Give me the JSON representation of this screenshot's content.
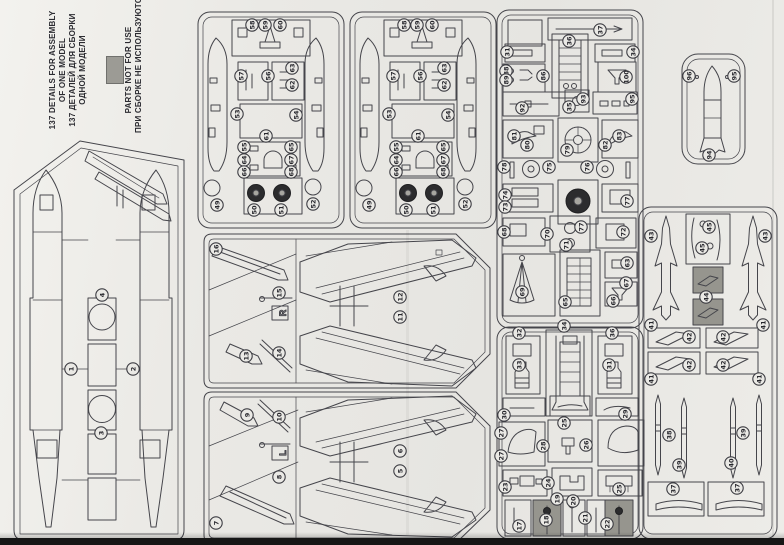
{
  "document": {
    "kind": "model kit sprue parts map (photographed sheet)",
    "header": {
      "count_note_en_1": "137 DETAILS FOR ASSEMBLY",
      "count_note_en_2": "OF ONE MODEL",
      "count_note_ru_1": "137 ДЕТАЛЕЙ ДЛЯ СБОРКИ",
      "count_note_ru_2": "ОДНОЙ МОДЕЛИ",
      "not_for_use_en": "PARTS NOT FOR USE",
      "not_for_use_ru": "ПРИ СБОРКЕ НЕ ИСПОЛЬЗУЮТСЯ",
      "not_for_use_swatch": "#9c9b95"
    }
  },
  "colors": {
    "paper": "#e9e8e4",
    "line": "#45454b",
    "shade": "#96958e",
    "wheel": "#2c2c2e",
    "edge_strip": "#161616"
  },
  "sprues": [
    {
      "id": "A",
      "name": "fuselage-sprue",
      "markers": [
        {
          "n": "4",
          "x": 102,
          "y": 295
        },
        {
          "n": "1",
          "x": 71,
          "y": 369
        },
        {
          "n": "2",
          "x": 133,
          "y": 369
        },
        {
          "n": "3",
          "x": 101,
          "y": 433
        }
      ]
    },
    {
      "id": "B",
      "name": "small-parts-sprue-1",
      "markers": [
        {
          "n": "58",
          "x": 252,
          "y": 25
        },
        {
          "n": "59",
          "x": 265,
          "y": 25
        },
        {
          "n": "60",
          "x": 280,
          "y": 25
        },
        {
          "n": "57",
          "x": 241,
          "y": 76
        },
        {
          "n": "56",
          "x": 268,
          "y": 76
        },
        {
          "n": "63",
          "x": 292,
          "y": 68
        },
        {
          "n": "62",
          "x": 292,
          "y": 85
        },
        {
          "n": "53",
          "x": 237,
          "y": 114
        },
        {
          "n": "54",
          "x": 296,
          "y": 115
        },
        {
          "n": "61",
          "x": 266,
          "y": 136
        },
        {
          "n": "55",
          "x": 244,
          "y": 147
        },
        {
          "n": "64",
          "x": 244,
          "y": 160
        },
        {
          "n": "66",
          "x": 244,
          "y": 172
        },
        {
          "n": "65",
          "x": 291,
          "y": 147
        },
        {
          "n": "67",
          "x": 291,
          "y": 160
        },
        {
          "n": "68",
          "x": 291,
          "y": 172
        },
        {
          "n": "49",
          "x": 217,
          "y": 205
        },
        {
          "n": "50",
          "x": 254,
          "y": 210
        },
        {
          "n": "51",
          "x": 281,
          "y": 210
        },
        {
          "n": "52",
          "x": 313,
          "y": 204
        }
      ]
    },
    {
      "id": "C",
      "name": "small-parts-sprue-2",
      "markers": [
        {
          "n": "58",
          "x": 404,
          "y": 25
        },
        {
          "n": "59",
          "x": 417,
          "y": 25
        },
        {
          "n": "60",
          "x": 432,
          "y": 25
        },
        {
          "n": "57",
          "x": 393,
          "y": 76
        },
        {
          "n": "56",
          "x": 420,
          "y": 76
        },
        {
          "n": "63",
          "x": 444,
          "y": 68
        },
        {
          "n": "62",
          "x": 444,
          "y": 85
        },
        {
          "n": "53",
          "x": 389,
          "y": 114
        },
        {
          "n": "54",
          "x": 448,
          "y": 115
        },
        {
          "n": "61",
          "x": 418,
          "y": 136
        },
        {
          "n": "55",
          "x": 396,
          "y": 147
        },
        {
          "n": "64",
          "x": 396,
          "y": 160
        },
        {
          "n": "66",
          "x": 396,
          "y": 172
        },
        {
          "n": "65",
          "x": 443,
          "y": 147
        },
        {
          "n": "67",
          "x": 443,
          "y": 160
        },
        {
          "n": "68",
          "x": 443,
          "y": 172
        },
        {
          "n": "49",
          "x": 369,
          "y": 205
        },
        {
          "n": "50",
          "x": 406,
          "y": 210
        },
        {
          "n": "51",
          "x": 433,
          "y": 210
        },
        {
          "n": "52",
          "x": 465,
          "y": 204
        }
      ]
    },
    {
      "id": "D",
      "name": "detail-sprue-upper",
      "markers": [
        {
          "n": "37",
          "x": 600,
          "y": 30
        },
        {
          "n": "36",
          "x": 569,
          "y": 41
        },
        {
          "n": "31",
          "x": 507,
          "y": 52
        },
        {
          "n": "34",
          "x": 633,
          "y": 52
        },
        {
          "n": "88",
          "x": 506,
          "y": 71
        },
        {
          "n": "89",
          "x": 506,
          "y": 80
        },
        {
          "n": "86",
          "x": 543,
          "y": 76
        },
        {
          "n": "100",
          "x": 626,
          "y": 77
        },
        {
          "n": "92",
          "x": 522,
          "y": 108
        },
        {
          "n": "35",
          "x": 569,
          "y": 107
        },
        {
          "n": "93",
          "x": 583,
          "y": 99
        },
        {
          "n": "95",
          "x": 632,
          "y": 99
        },
        {
          "n": "81",
          "x": 514,
          "y": 136
        },
        {
          "n": "80",
          "x": 527,
          "y": 145
        },
        {
          "n": "79",
          "x": 567,
          "y": 150
        },
        {
          "n": "82",
          "x": 605,
          "y": 145
        },
        {
          "n": "83",
          "x": 619,
          "y": 136
        },
        {
          "n": "78",
          "x": 504,
          "y": 167
        },
        {
          "n": "75",
          "x": 549,
          "y": 167
        },
        {
          "n": "76",
          "x": 587,
          "y": 167
        },
        {
          "n": "74",
          "x": 505,
          "y": 195
        },
        {
          "n": "73",
          "x": 505,
          "y": 207
        },
        {
          "n": "77",
          "x": 627,
          "y": 201
        },
        {
          "n": "68",
          "x": 504,
          "y": 232
        },
        {
          "n": "70",
          "x": 547,
          "y": 234
        },
        {
          "n": "71",
          "x": 566,
          "y": 245
        },
        {
          "n": "77",
          "x": 581,
          "y": 227
        },
        {
          "n": "72",
          "x": 623,
          "y": 232
        },
        {
          "n": "69",
          "x": 522,
          "y": 292
        },
        {
          "n": "63",
          "x": 627,
          "y": 263
        },
        {
          "n": "67",
          "x": 626,
          "y": 283
        },
        {
          "n": "66",
          "x": 613,
          "y": 301
        },
        {
          "n": "65",
          "x": 565,
          "y": 302
        }
      ]
    },
    {
      "id": "E",
      "name": "detail-sprue-lower",
      "markers": [
        {
          "n": "34",
          "x": 564,
          "y": 326
        },
        {
          "n": "32",
          "x": 519,
          "y": 333
        },
        {
          "n": "36",
          "x": 612,
          "y": 333
        },
        {
          "n": "33",
          "x": 519,
          "y": 365
        },
        {
          "n": "31",
          "x": 609,
          "y": 365
        },
        {
          "n": "30",
          "x": 504,
          "y": 415
        },
        {
          "n": "29",
          "x": 625,
          "y": 414
        },
        {
          "n": "25",
          "x": 564,
          "y": 423
        },
        {
          "n": "27",
          "x": 501,
          "y": 433
        },
        {
          "n": "27",
          "x": 501,
          "y": 456
        },
        {
          "n": "28",
          "x": 543,
          "y": 446
        },
        {
          "n": "26",
          "x": 586,
          "y": 445
        },
        {
          "n": "24",
          "x": 548,
          "y": 483
        },
        {
          "n": "23",
          "x": 505,
          "y": 487
        },
        {
          "n": "25",
          "x": 619,
          "y": 489
        },
        {
          "n": "19",
          "x": 557,
          "y": 499
        },
        {
          "n": "20",
          "x": 573,
          "y": 501
        },
        {
          "n": "18",
          "x": 546,
          "y": 520
        },
        {
          "n": "21",
          "x": 585,
          "y": 518
        },
        {
          "n": "17",
          "x": 519,
          "y": 526
        },
        {
          "n": "22",
          "x": 607,
          "y": 524
        }
      ]
    },
    {
      "id": "F",
      "name": "bomb-sprue",
      "markers": [
        {
          "n": "96",
          "x": 689,
          "y": 76
        },
        {
          "n": "95",
          "x": 734,
          "y": 76
        },
        {
          "n": "94",
          "x": 709,
          "y": 155
        }
      ]
    },
    {
      "id": "G",
      "name": "missile-sprue",
      "markers": [
        {
          "n": "43",
          "x": 651,
          "y": 236
        },
        {
          "n": "43",
          "x": 765,
          "y": 236
        },
        {
          "n": "45",
          "x": 709,
          "y": 227
        },
        {
          "n": "45",
          "x": 702,
          "y": 248
        },
        {
          "n": "44",
          "x": 706,
          "y": 297
        },
        {
          "n": "41",
          "x": 651,
          "y": 325
        },
        {
          "n": "41",
          "x": 763,
          "y": 325
        },
        {
          "n": "42",
          "x": 689,
          "y": 337
        },
        {
          "n": "42",
          "x": 723,
          "y": 337
        },
        {
          "n": "42",
          "x": 689,
          "y": 365
        },
        {
          "n": "42",
          "x": 723,
          "y": 365
        },
        {
          "n": "41",
          "x": 651,
          "y": 379
        },
        {
          "n": "41",
          "x": 759,
          "y": 379
        },
        {
          "n": "38",
          "x": 669,
          "y": 435
        },
        {
          "n": "39",
          "x": 679,
          "y": 465
        },
        {
          "n": "39",
          "x": 743,
          "y": 433
        },
        {
          "n": "40",
          "x": 731,
          "y": 463
        },
        {
          "n": "37",
          "x": 673,
          "y": 489
        },
        {
          "n": "37",
          "x": 737,
          "y": 488
        }
      ]
    },
    {
      "id": "H",
      "name": "wing-sprue-right",
      "letter": "R",
      "markers": [
        {
          "n": "16",
          "x": 216,
          "y": 249
        },
        {
          "n": "15",
          "x": 279,
          "y": 293
        },
        {
          "n": "12",
          "x": 400,
          "y": 297
        },
        {
          "n": "11",
          "x": 400,
          "y": 317
        },
        {
          "n": "13",
          "x": 246,
          "y": 356
        },
        {
          "n": "14",
          "x": 279,
          "y": 353
        }
      ]
    },
    {
      "id": "I",
      "name": "wing-sprue-left",
      "letter": "L",
      "markers": [
        {
          "n": "9",
          "x": 247,
          "y": 415
        },
        {
          "n": "10",
          "x": 279,
          "y": 417
        },
        {
          "n": "6",
          "x": 400,
          "y": 451
        },
        {
          "n": "5",
          "x": 400,
          "y": 471
        },
        {
          "n": "8",
          "x": 279,
          "y": 477
        },
        {
          "n": "7",
          "x": 216,
          "y": 523
        }
      ]
    }
  ]
}
